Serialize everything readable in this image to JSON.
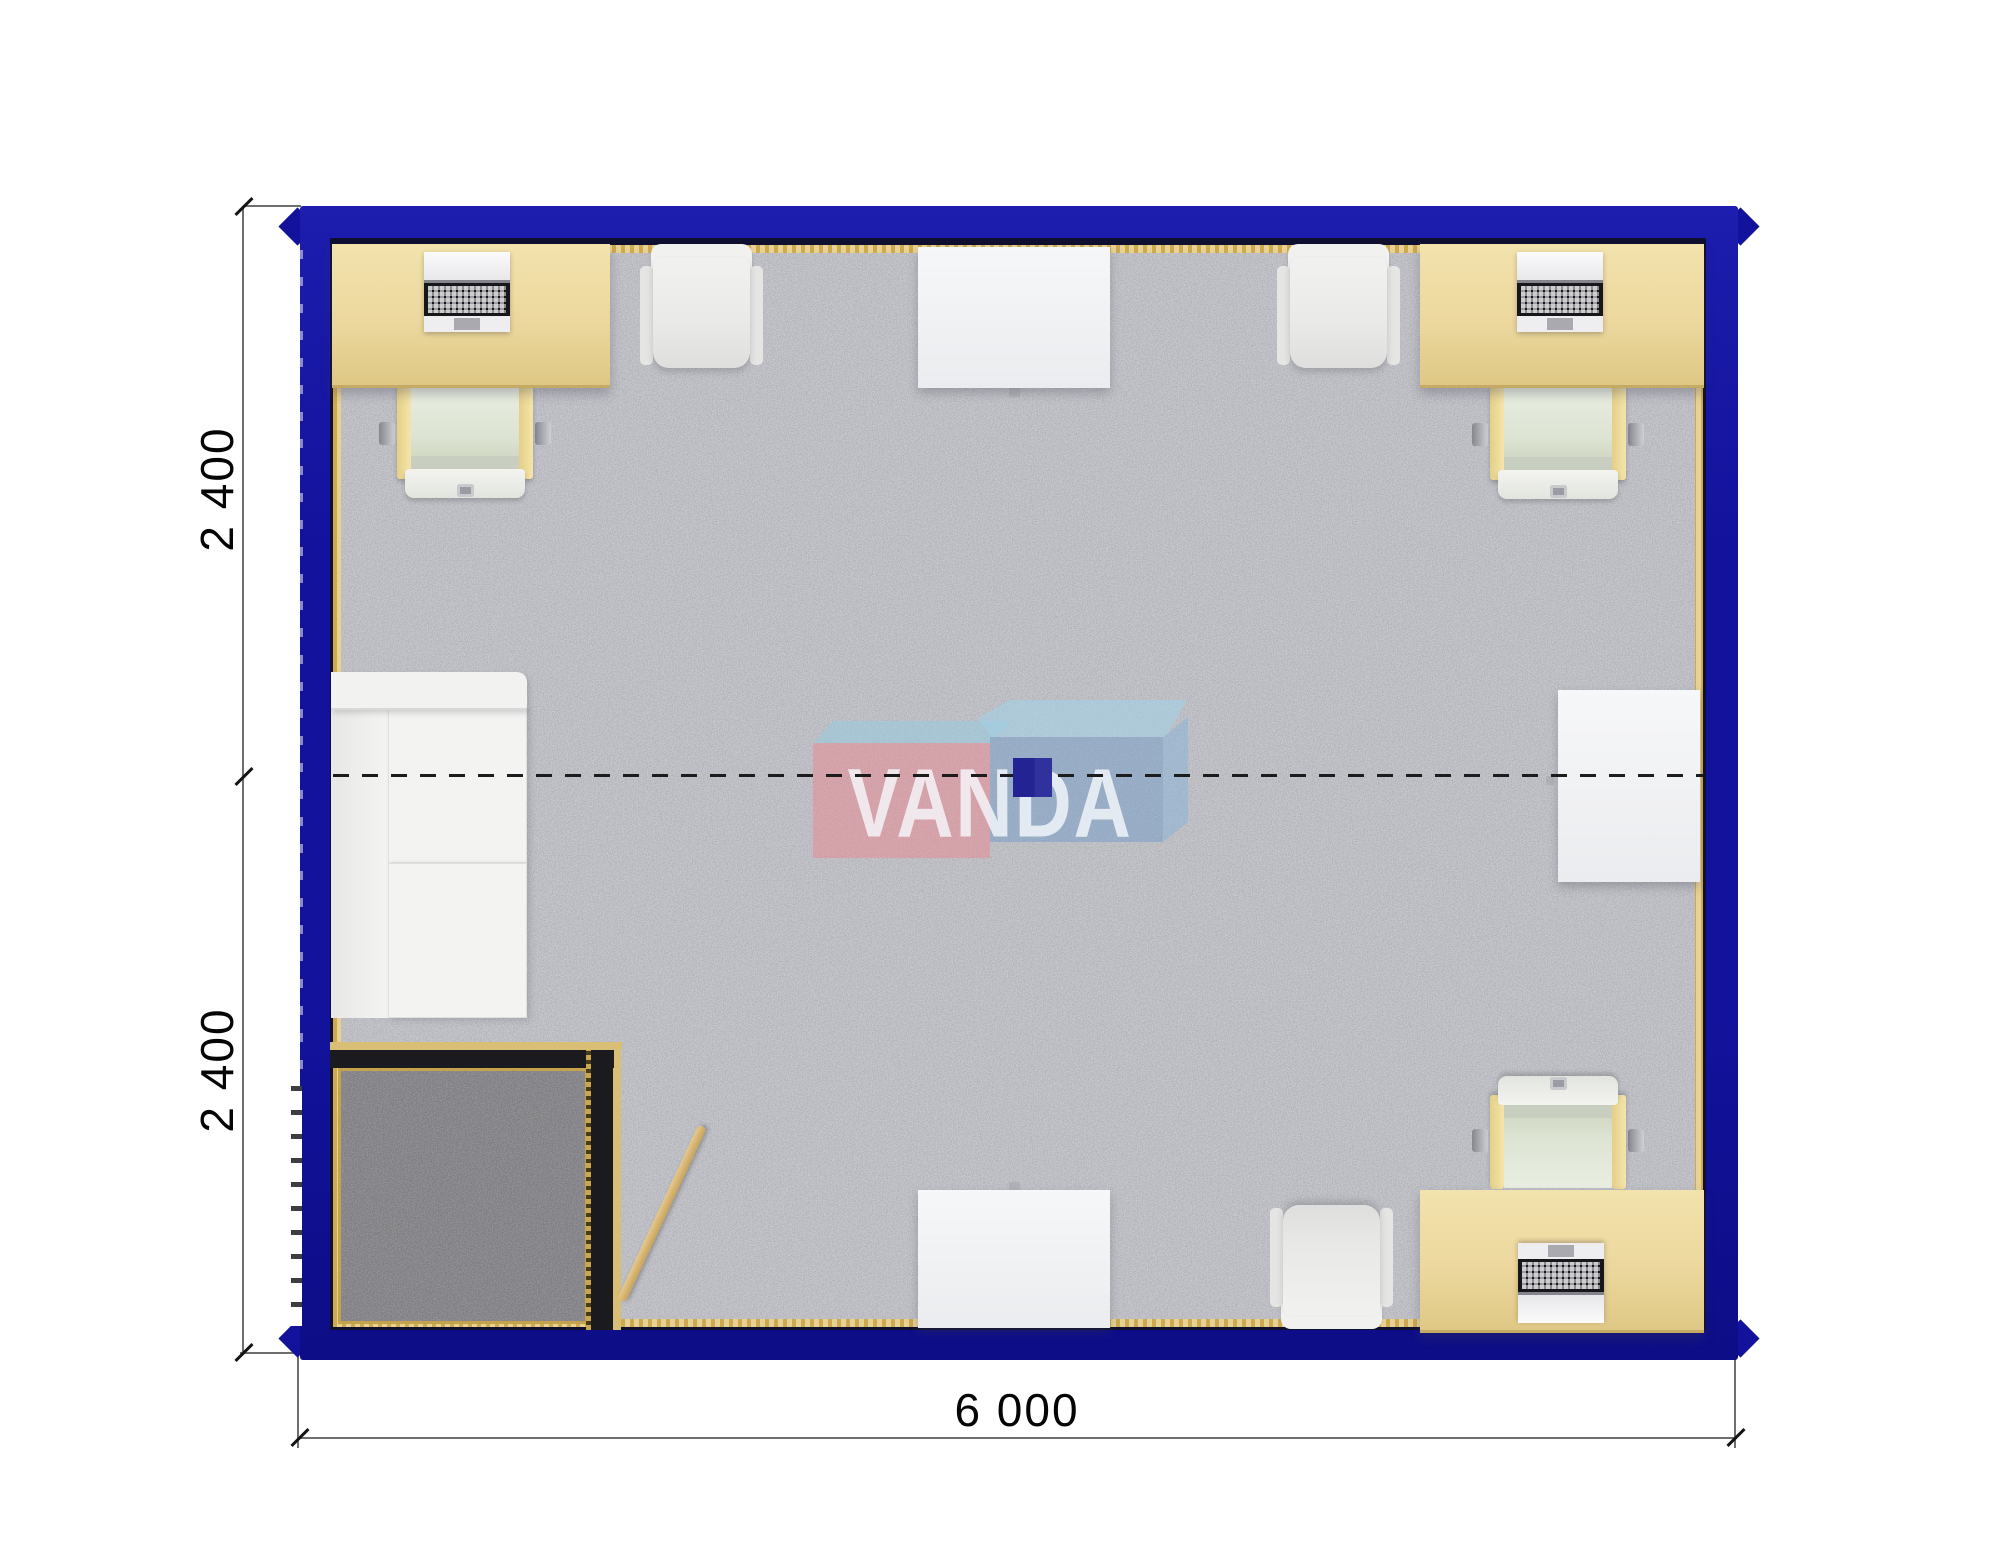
{
  "plan": {
    "kind": "modular container office floor plan (top-down render)",
    "rooms": [
      "main-office",
      "entrance-vestibule"
    ],
    "units": "millimetres"
  },
  "dimensions": {
    "left_top": "2 400",
    "left_bottom": "2 400",
    "bottom": "6 000"
  },
  "watermark": {
    "text": "VANDA"
  },
  "colors": {
    "wall_blue": "#12129c",
    "inner_wall_dark": "#0f0f30",
    "trim_gold": "#d9be76",
    "carpet_gray": "#cbccd2",
    "vestibule_carpet": "#97979a",
    "desk_beige": "#ecd89e",
    "chair_seat_green": "#dde4d3",
    "logo_pink": "#e6949b",
    "logo_light_blue": "#a0cadd",
    "logo_steel_blue": "#7da0c8",
    "logo_navy_square": "#232394"
  },
  "furniture_inventory": {
    "desks_with_laptops": 3,
    "office_chairs": 3,
    "armchairs": 3,
    "white_tables": 3,
    "sofas": 1,
    "entrance_doors": 1
  }
}
